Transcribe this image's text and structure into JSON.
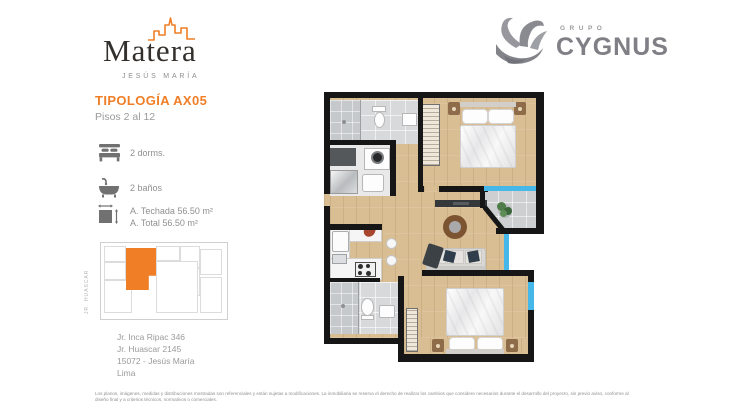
{
  "header": {
    "brand": {
      "wordmark": "Matera",
      "district": "JESÚS MARÍA"
    },
    "developer": {
      "group_label": "GRUPO",
      "name": "CYGNUS"
    }
  },
  "typology": {
    "title": "TIPOLOGÍA AX05",
    "floors_range": "Pisos 2 al 12"
  },
  "specs": {
    "bedrooms": "2 dorms.",
    "bathrooms": "2 baños",
    "covered_area": "A. Techada 56.50 m²",
    "total_area": "A. Total 56.50 m²"
  },
  "keyplan": {
    "street": "JR. HUASCAR"
  },
  "address": {
    "line1": "Jr. Inca Ripac 346",
    "line2": "Jr. Huascar 2145",
    "line3": "15072 - Jesús María",
    "line4": "Lima"
  },
  "footer": {
    "disclaimer": "Los planos, imágenes, medidas y distribuciones mostradas son referenciales y están sujetas a modificaciones. La inmobiliaria se reserva el derecho de realizar los cambios que considere necesarios durante el desarrollo del proyecto, sin previo aviso, conforme al diseño final y a criterios técnicos, normativos o comerciales."
  },
  "colors": {
    "accent": "#F07E26",
    "window_glass": "#45B7E8",
    "wall": "#161616",
    "wood_floor": "#DABE93",
    "tile": "#D7D9DB",
    "logo_gray": "#82828A"
  }
}
